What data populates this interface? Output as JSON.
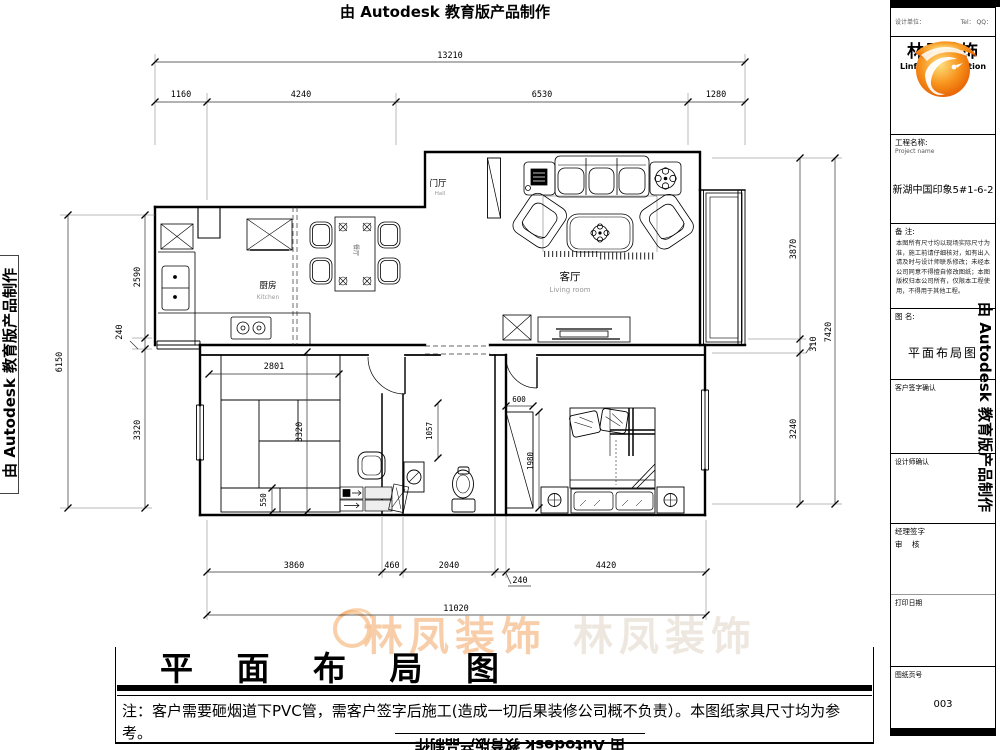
{
  "banner": {
    "autodesk": "由 Autodesk 教育版产品制作"
  },
  "watermark": {
    "text": "林凤装饰"
  },
  "plan": {
    "rooms": {
      "entry": {
        "name": "门厅",
        "sub": "Hall"
      },
      "kitchen": {
        "name": "厨房",
        "sub": "Kitchen"
      },
      "living": {
        "name": "客厅",
        "sub": "Living room"
      },
      "dining": {
        "name": "餐厅"
      }
    },
    "dims": {
      "top_total": "13210",
      "top_chain": [
        "1160",
        "4240",
        "6530",
        "1280"
      ],
      "left_total": "6150",
      "left_chain": [
        "2590",
        "240",
        "3320"
      ],
      "right_total": "7420",
      "right_chain": [
        "3870",
        "310",
        "3240"
      ],
      "bottom_total": "11020",
      "bottom_chain": [
        "3860",
        "460",
        "2040",
        "240",
        "4420"
      ],
      "interior": {
        "tatami_w": "2801",
        "tatami_h": "3320",
        "cabinet": "550",
        "bath": "1057",
        "wardrobe_w": "600",
        "wardrobe_h": "1980"
      }
    }
  },
  "footer": {
    "title": "平 面 布 局 图",
    "note": "注：客户需要砸烟道下PVC管，需客户签字后施工(造成一切后果装修公司概不负责）。本图纸家具尺寸均为参考。"
  },
  "title_block": {
    "top_left": "设计单位：",
    "top_right": "Tel： QQ：",
    "logo_cn": "林凤装饰",
    "logo_en": "Linfeng Decoration",
    "project_label": "工程名称:",
    "project_sub": "Project name",
    "project_value": "新湖中国印象5#1-6-2",
    "remark_label": "备 注:",
    "remark_text": "本图所有尺寸均以现场实际尺寸为准，施工前请仔细核对，如有出入请及时与设计师联系修改；未经本公司同意不得擅自修改图纸；本图版权归本公司所有，仅限本工程使用，不得用于其他工程。",
    "drawing_label": "图 名:",
    "drawing_value": "平面布局图",
    "client_sign_label": "客户签字确认",
    "designer_label": "设计师确认",
    "manager_label": "经理签字",
    "audit_label": "审    核",
    "print_label": "打印日期",
    "page_label": "图纸页号",
    "page_value": "003"
  },
  "colors": {
    "accent": "#f08300",
    "wall": "#000000"
  }
}
